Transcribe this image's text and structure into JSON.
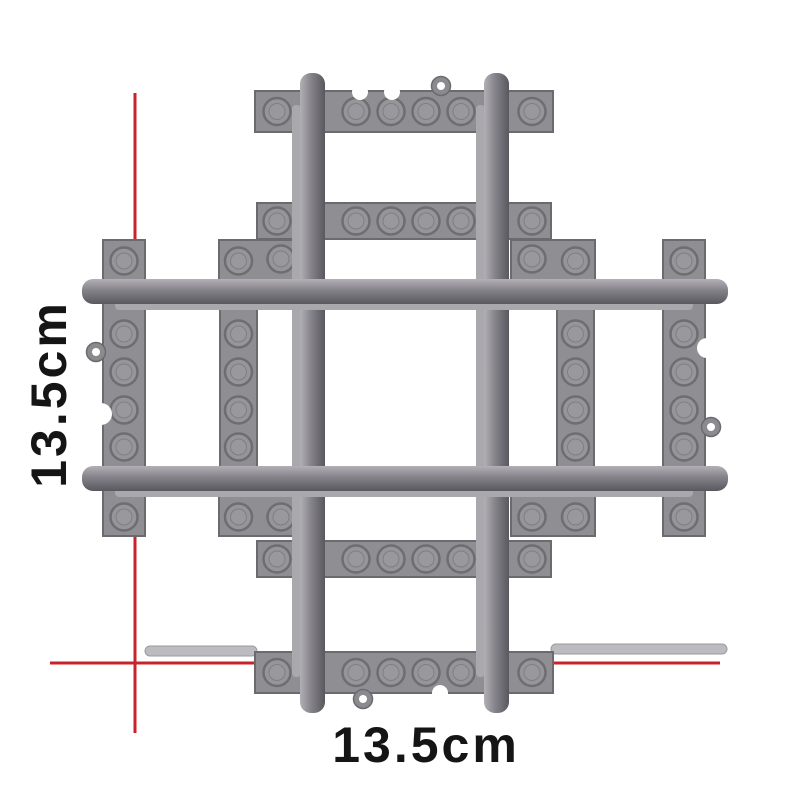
{
  "image": {
    "background": "#ffffff",
    "subject_icon": "toy-train-track-crossing"
  },
  "dimension_annotation": {
    "vertical_label": "13.5cm",
    "horizontal_label": "13.5cm",
    "line_color": "#c7232a",
    "label_color": "#151515",
    "vertical_line": {
      "x": 135,
      "y1": 93,
      "y2": 733
    },
    "horizontal_line": {
      "y": 663,
      "x1": 50,
      "x2": 720
    }
  },
  "track": {
    "palette": {
      "plate": "#8f8e93",
      "plate_edge": "#6b6a6f",
      "stud_fill": "#96959a",
      "stud_inner": "#9c9ba0",
      "stud_edge": "#6e6d72",
      "rail_light": "#b2b0b5",
      "rail_mid": "#85838a",
      "rail_dark": "#5a585f",
      "flange": "#a9a8ad",
      "strip": "#bcbbbf",
      "strip_edge": "#9b9a9f",
      "ring": "#8b8a8f",
      "hole": "#ffffff"
    },
    "sleeper_rows": [
      {
        "x": 255,
        "y": 91,
        "w": 298,
        "h": 41
      },
      {
        "x": 257,
        "y": 203,
        "w": 294,
        "h": 36
      },
      {
        "x": 257,
        "y": 541,
        "w": 294,
        "h": 36
      },
      {
        "x": 255,
        "y": 652,
        "w": 298,
        "h": 41
      }
    ],
    "row_stud_xs": [
      277,
      356,
      391,
      426,
      461,
      532
    ],
    "sleeper_columns": [
      {
        "x": 103,
        "y": 240,
        "w": 42,
        "h": 296
      },
      {
        "x": 220,
        "y": 240,
        "w": 37,
        "h": 296
      },
      {
        "x": 557,
        "y": 240,
        "w": 37,
        "h": 296
      },
      {
        "x": 663,
        "y": 240,
        "w": 42,
        "h": 296
      }
    ],
    "column_stud_ys": [
      261,
      334,
      372,
      410,
      447,
      517
    ],
    "corner_plates": [
      {
        "x": 219,
        "y": 240,
        "w": 84,
        "h": 62,
        "stud": {
          "cx": 281,
          "cy": 259
        }
      },
      {
        "x": 511,
        "y": 240,
        "w": 84,
        "h": 62,
        "stud": {
          "cx": 532,
          "cy": 259
        }
      },
      {
        "x": 219,
        "y": 474,
        "w": 84,
        "h": 62,
        "stud": {
          "cx": 281,
          "cy": 517
        }
      },
      {
        "x": 511,
        "y": 474,
        "w": 84,
        "h": 62,
        "stud": {
          "cx": 532,
          "cy": 517
        }
      }
    ],
    "stud_radius": 13.5,
    "vertical_rails": [
      {
        "x": 300
      },
      {
        "x": 484
      }
    ],
    "vertical_rail": {
      "w": 25,
      "y1": 73,
      "y2": 713
    },
    "horizontal_rails": [
      {
        "y": 279
      },
      {
        "y": 466
      }
    ],
    "horizontal_rail": {
      "h": 25,
      "x1": 82,
      "x2": 728
    },
    "rings": [
      {
        "cx": 441,
        "cy": 86
      },
      {
        "cx": 363,
        "cy": 699
      },
      {
        "cx": 96,
        "cy": 352
      },
      {
        "cx": 711,
        "cy": 427
      }
    ],
    "notches": [
      {
        "cx": 360,
        "cy": 92,
        "r": 8
      },
      {
        "cx": 392,
        "cy": 92,
        "r": 8
      },
      {
        "cx": 440,
        "cy": 693,
        "r": 8
      },
      {
        "cx": 101,
        "cy": 414,
        "r": 11
      },
      {
        "cx": 707,
        "cy": 348,
        "r": 10
      }
    ],
    "side_strips": [
      {
        "x": 145,
        "y": 646,
        "w": 112,
        "h": 10
      },
      {
        "x": 551,
        "y": 644,
        "w": 176,
        "h": 10
      }
    ]
  }
}
